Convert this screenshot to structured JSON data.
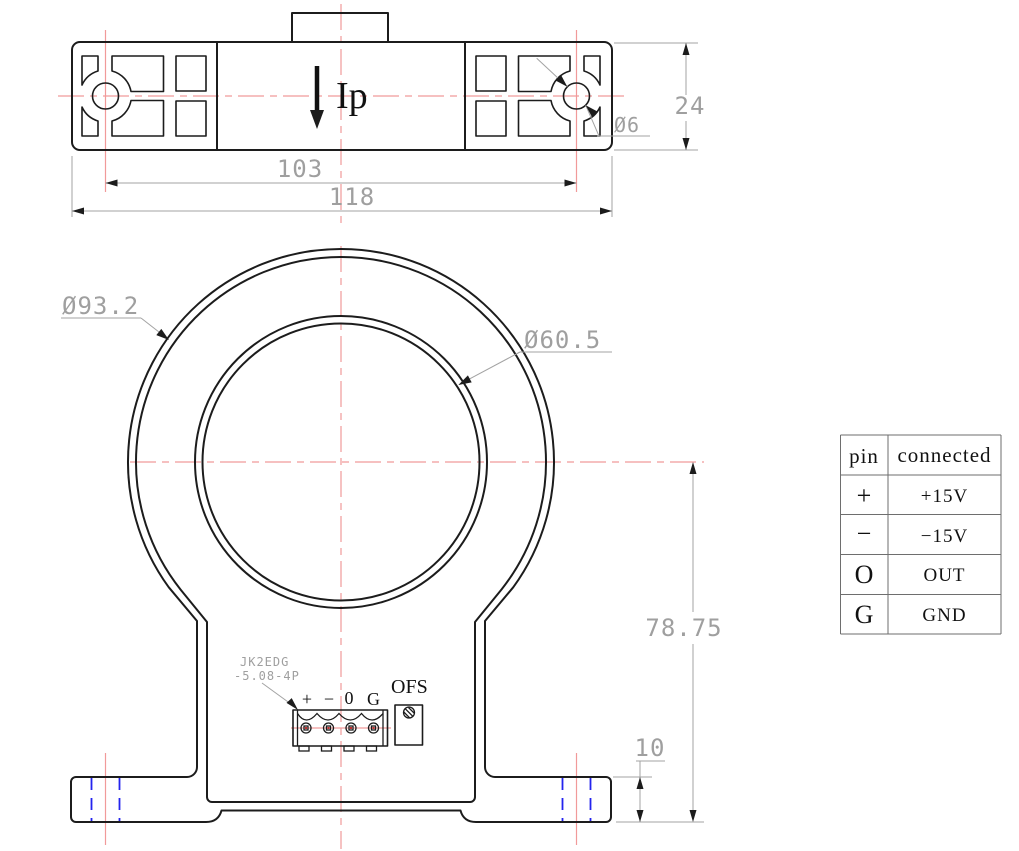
{
  "top_view": {
    "ip_label": "Ip",
    "dim_hole_spacing": "103",
    "dim_overall_width": "118",
    "dim_height": "24",
    "dim_mount_hole": "Ø6"
  },
  "front_view": {
    "dim_outer_diameter": "Ø93.2",
    "dim_aperture_diameter": "Ø60.5",
    "dim_center_to_bottom": "78.75",
    "dim_foot_height": "10",
    "connector_ref_line1": "JK2EDG",
    "connector_ref_line2": "-5.08-4P",
    "pin_labels": [
      "+",
      "−",
      "0",
      "G"
    ],
    "ofs_label": "OFS"
  },
  "pin_table": {
    "header": [
      "pin",
      "connected"
    ],
    "rows": [
      [
        "+",
        "+15V"
      ],
      [
        "−",
        "−15V"
      ],
      [
        "O",
        "OUT"
      ],
      [
        "G",
        "GND"
      ]
    ]
  },
  "colors": {
    "outline": "#1c1c1c",
    "dimension": "#9f9f9f",
    "centerline": "#f19a9a",
    "hidden_line": "#2424ee"
  }
}
